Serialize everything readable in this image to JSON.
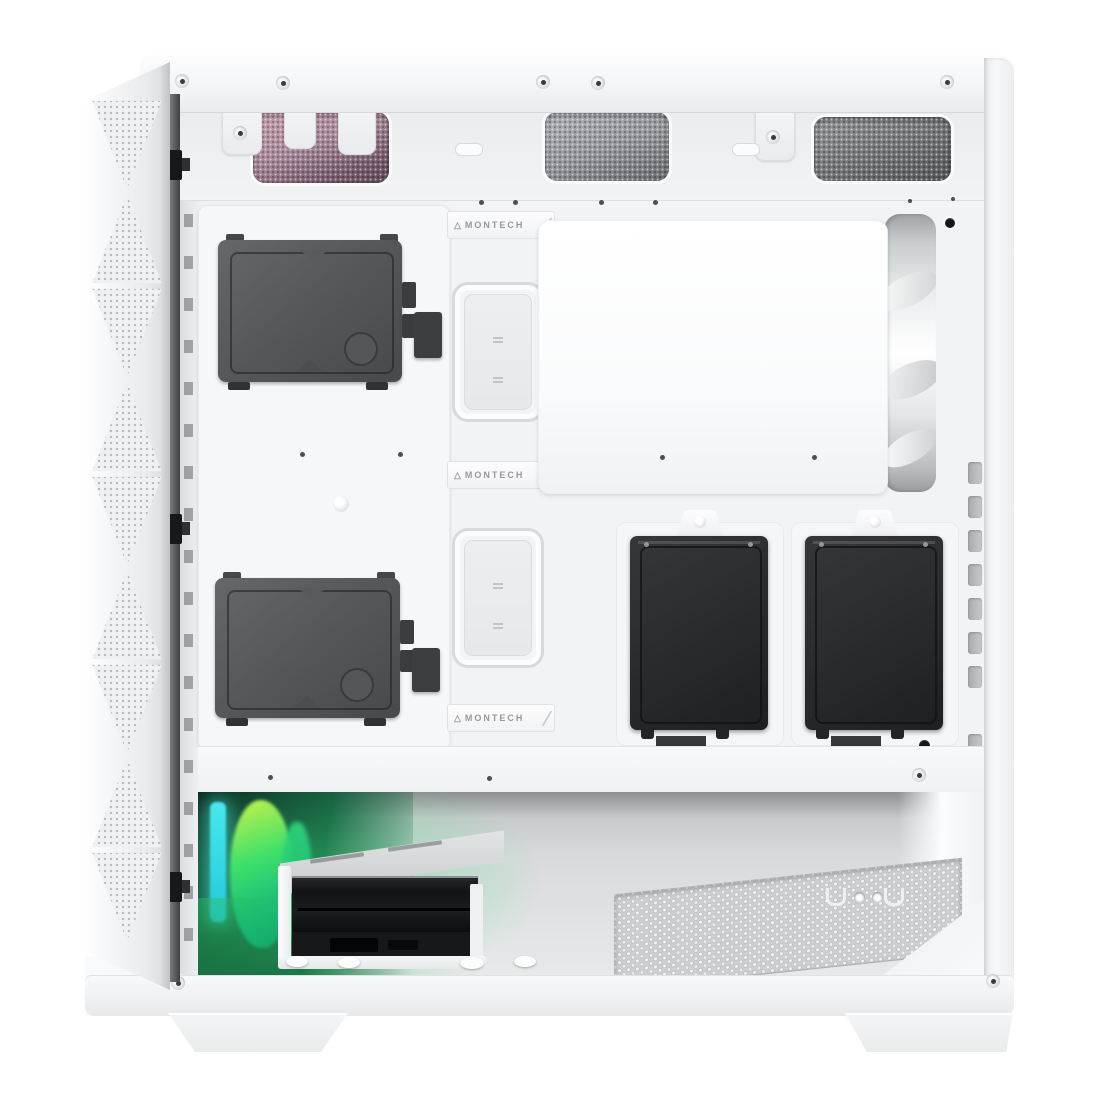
{
  "scene": {
    "description": "White mid-tower PC case, side panel removed, interior view with front mesh panel, two 3.5in HDDs, two 2.5in SSDs, rear white fan, RGB intake fan glowing green, PSU basement with drive cage and vented floor",
    "background_color": "#ffffff"
  },
  "brand": {
    "name": "MONTECH",
    "logo_char": "△"
  },
  "badges": [
    {
      "text": "MONTECH"
    },
    {
      "text": "MONTECH"
    },
    {
      "text": "MONTECH"
    }
  ],
  "colors": {
    "shell_white": "#f4f5f7",
    "interior_white": "#f2f3f5",
    "hdd_gray": "#57585c",
    "ssd_black": "#2a2b2f",
    "top_vent_pink": "#a8899a",
    "top_vent_gray": "#97989d",
    "rgb_green": "#3fe06a",
    "rgb_cyan": "#35d8e0",
    "basement_metal": "#d8dadb"
  },
  "components": {
    "hdd_count": 2,
    "ssd_count": 2,
    "top_vents": 3,
    "cable_grommets": 2,
    "brand_badges": 3,
    "tie_down_slots": 9,
    "front_panel_clips": 3
  }
}
